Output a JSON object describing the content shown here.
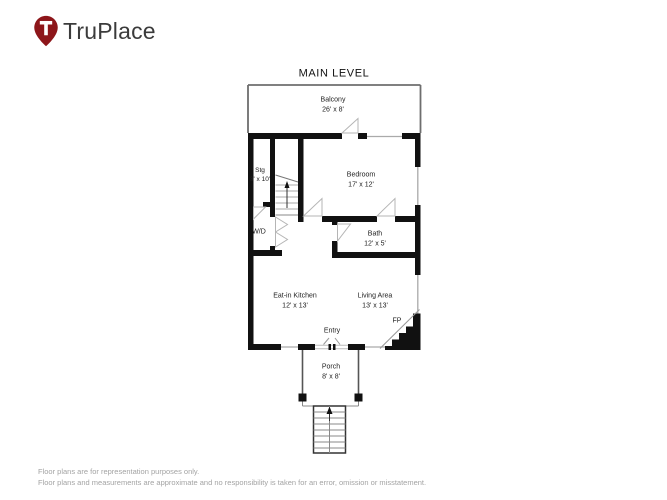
{
  "header": {
    "brand": "TruPlace",
    "brand_color": "#8d161a"
  },
  "plan": {
    "title": "MAIN LEVEL",
    "wall_color": "#111111",
    "rooms": {
      "balcony": {
        "name": "Balcony",
        "dims": "26' x 8'"
      },
      "bedroom": {
        "name": "Bedroom",
        "dims": "17' x 12'"
      },
      "storage": {
        "name": "Stg",
        "dims": "3' x 10'"
      },
      "washer_dryer": {
        "name": "W/D",
        "dims": ""
      },
      "bath": {
        "name": "Bath",
        "dims": "12' x 5'"
      },
      "kitchen": {
        "name": "Eat-in Kitchen",
        "dims": "12' x 13'"
      },
      "living": {
        "name": "Living Area",
        "dims": "13' x 13'"
      },
      "porch": {
        "name": "Porch",
        "dims": "8' x 8'"
      }
    },
    "annotations": {
      "entry": "Entry",
      "fireplace": "FP"
    }
  },
  "footer": {
    "line1": "Floor plans are for representation purposes only.",
    "line2": "Floor plans and measurements are approximate and no responsibility is taken for an error, omission or misstatement."
  }
}
